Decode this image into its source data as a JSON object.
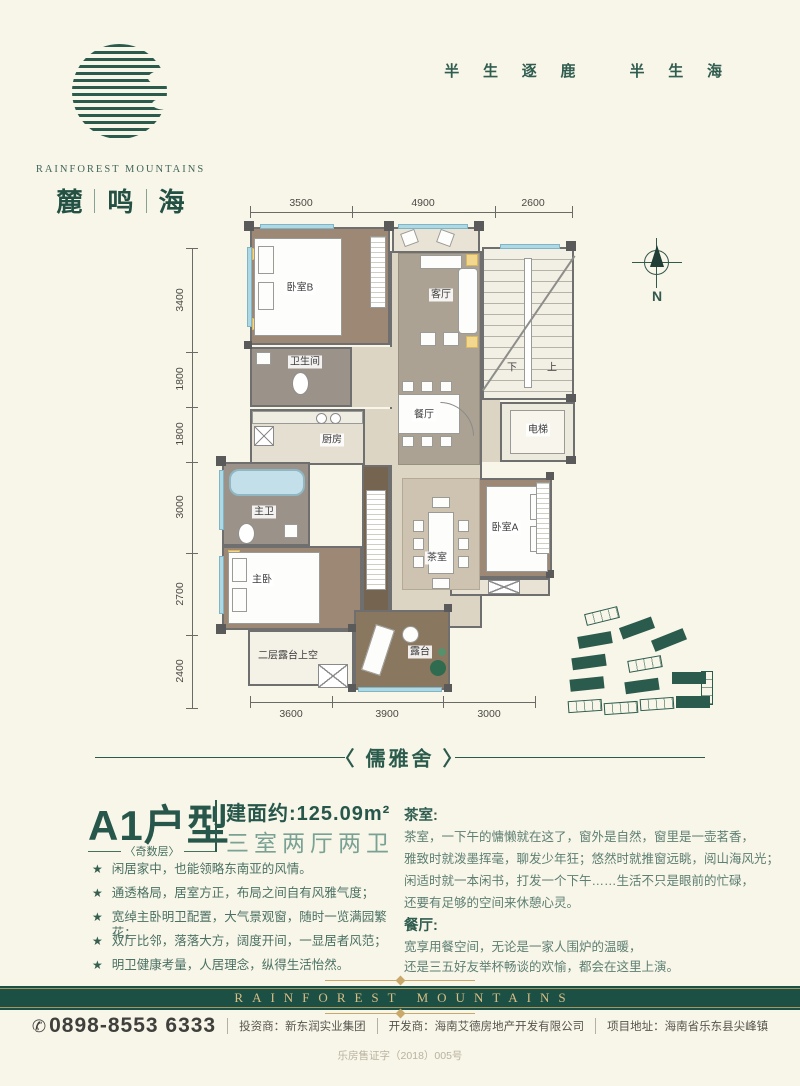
{
  "brand": {
    "logo_en": "RAINFOREST MOUNTAINS",
    "logo_cn_1": "麓",
    "logo_cn_2": "鸣",
    "logo_cn_3": "海",
    "slogan_left": "半 生 逐 鹿",
    "slogan_right": "半 生 海"
  },
  "plan": {
    "rooms": {
      "bedroom_b": "卧室B",
      "living": "客厅",
      "bathroom": "卫生间",
      "dining": "餐厅",
      "kitchen": "厨房",
      "elevator": "电梯",
      "master_bath": "主卫",
      "master_bed": "主卧",
      "tea": "茶室",
      "bedroom_a": "卧室A",
      "terrace_void": "二层露台上空",
      "terrace": "露台"
    },
    "stairs": {
      "down": "下",
      "up": "上"
    },
    "compass": "N",
    "dims": {
      "top": [
        "3500",
        "4900",
        "2600"
      ],
      "left": [
        "3400",
        "1800",
        "1800",
        "3000",
        "2700",
        "2400"
      ],
      "bottom": [
        "3600",
        "3900",
        "3000"
      ]
    }
  },
  "section": {
    "bracket_l": "〈",
    "title": "儒雅舍",
    "bracket_r": "〉"
  },
  "unit": {
    "name": "A1户型",
    "floor_note": "〈奇数层〉",
    "area": "建面约:125.09m²",
    "layout": "三室两厅两卫",
    "bullet": "★",
    "features": [
      "闲居家中，也能领略东南亚的风情。",
      "通透格局，居室方正，布局之间自有风雅气度；",
      "宽绰主卧明卫配置，大气景观窗，随时一览满园繁花；",
      "双厅比邻，落落大方，阔度开间，一显居者风范；",
      "明卫健康考量，人居理念，纵得生活怡然。"
    ]
  },
  "descriptions": {
    "tea_title": "茶室:",
    "tea_lines": [
      "茶室，一下午的慵懒就在这了，窗外是自然，窗里是一壶茗香，",
      "雅致时就泼墨挥毫，聊发少年狂；悠然时就推窗远眺，阅山海风光；",
      "闲适时就一本闲书，打发一个下午……生活不只是眼前的忙碌，",
      "还要有足够的空间来休憩心灵。"
    ],
    "dining_title": "餐厅:",
    "dining_lines": [
      "宽享用餐空间，无论是一家人围炉的温暖，",
      "还是三五好友举杯畅谈的欢愉，都会在这里上演。"
    ]
  },
  "banner": {
    "text": "RAINFOREST MOUNTAINS"
  },
  "footer": {
    "phone_icon": "✆",
    "phone_prefix": "0898-",
    "phone_bold": "8553 6333",
    "investor": "投资商：新东润实业集团",
    "developer": "开发商：海南艾德房地产开发有限公司",
    "address": "项目地址：海南省乐东县尖峰镇",
    "certificate": "乐房售证字（2018）005号"
  },
  "colors": {
    "accent_green": "#2a5b4c",
    "banner_green": "#1d5044",
    "gold": "#c9a869"
  }
}
